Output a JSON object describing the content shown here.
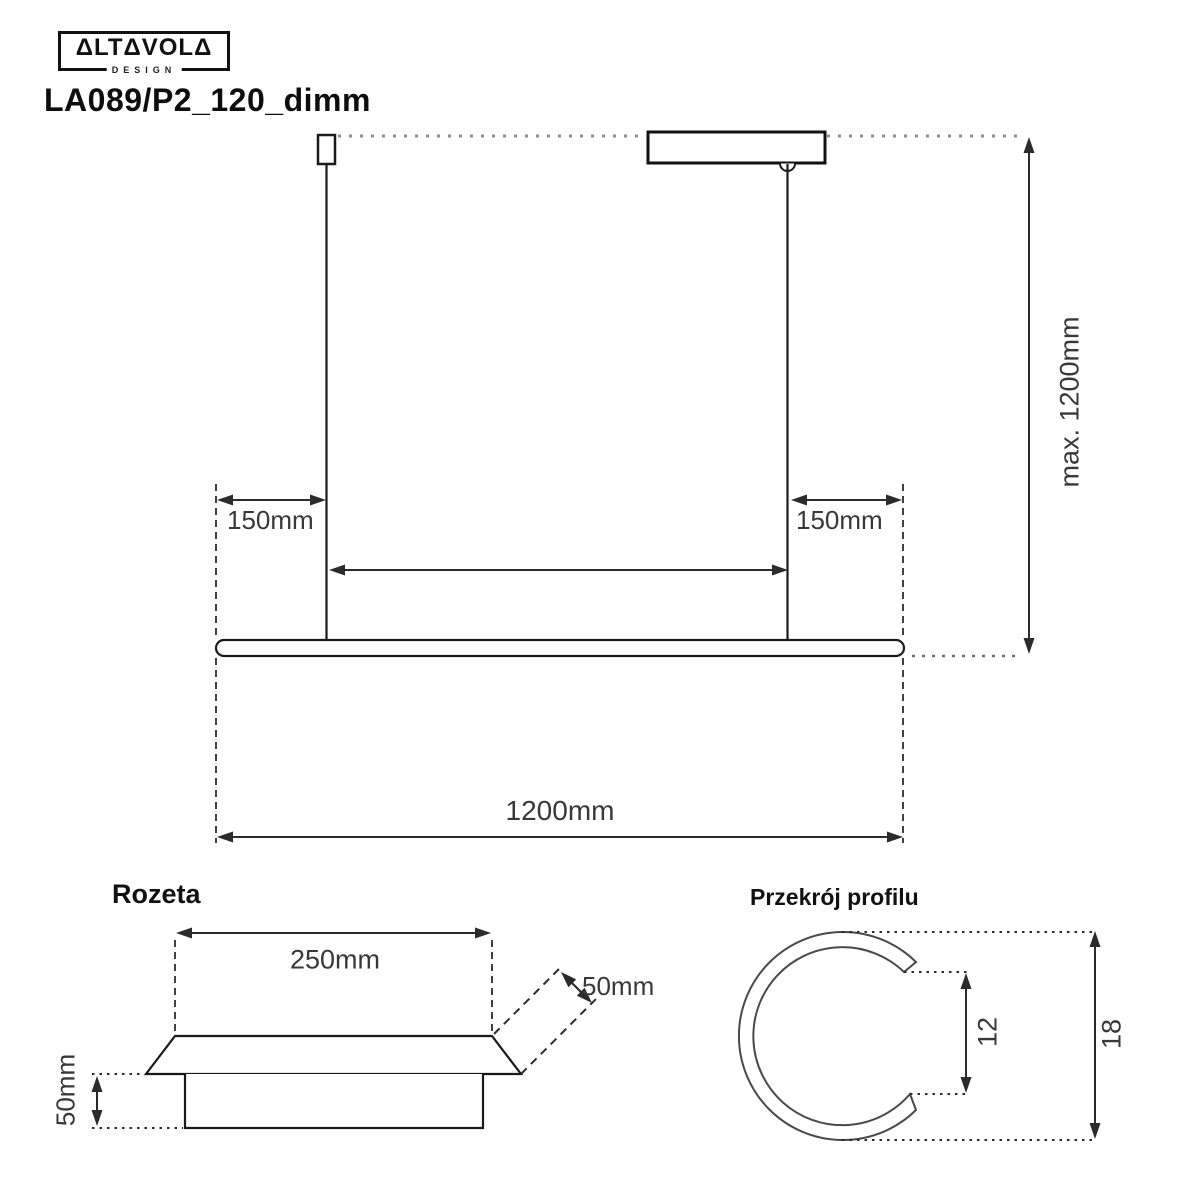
{
  "header": {
    "brand": "ΔLTΔVOLΔ",
    "brand_sub": "DESIGN",
    "product_code": "LA089/P2_120_dimm"
  },
  "main_drawing": {
    "dim_left_offset": "150mm",
    "dim_right_offset": "150mm",
    "dim_max_height": "max. 1200mm",
    "dim_total_width": "1200mm"
  },
  "rozeta": {
    "title": "Rozeta",
    "dim_width": "250mm",
    "dim_edge": "50mm",
    "dim_height": "50mm"
  },
  "profile": {
    "title": "Przekrój profilu",
    "dim_opening": "12",
    "dim_diameter": "18"
  },
  "colors": {
    "background": "#ffffff",
    "line": "#2b2b2b",
    "profile_line": "#4a4a4a",
    "dotted_line": "#8f8f8f",
    "dim_text": "#383838",
    "title_text": "#0d0d0d"
  }
}
